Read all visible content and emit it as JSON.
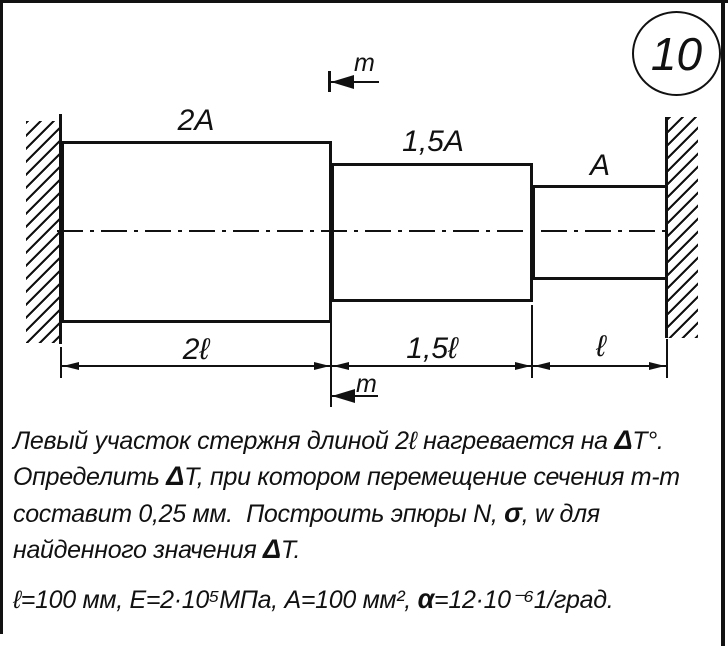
{
  "badge": {
    "number": "10"
  },
  "diagram": {
    "area_labels": {
      "left": "2A",
      "middle": "1,5A",
      "right": "A"
    },
    "length_labels": {
      "left": "2ℓ",
      "middle": "1,5ℓ",
      "right": "ℓ"
    },
    "section_marks": {
      "top": "m",
      "bottom": "m"
    }
  },
  "problem": {
    "line1": {
      "a": "Левый участок стержня длиной 2ℓ нагревается на ",
      "b": "Δ",
      "c": "T°."
    },
    "line2": {
      "a": "Определить ",
      "b": "Δ",
      "c": "T, при котором перемещение сечения m-m"
    },
    "line3": {
      "a": "составит 0,25 мм.  Построить эпюры N, ",
      "b": "σ",
      "c": ", w для"
    },
    "line4": {
      "a": "найденного значения ",
      "b": "Δ",
      "c": "T."
    },
    "given": {
      "a": "ℓ=100 мм, E=2·10⁵МПа, A=100 мм², ",
      "b": "α",
      "c": "=12·10⁻⁶1/град."
    }
  },
  "colors": {
    "ink": "#111111",
    "paper": "#ffffff"
  }
}
